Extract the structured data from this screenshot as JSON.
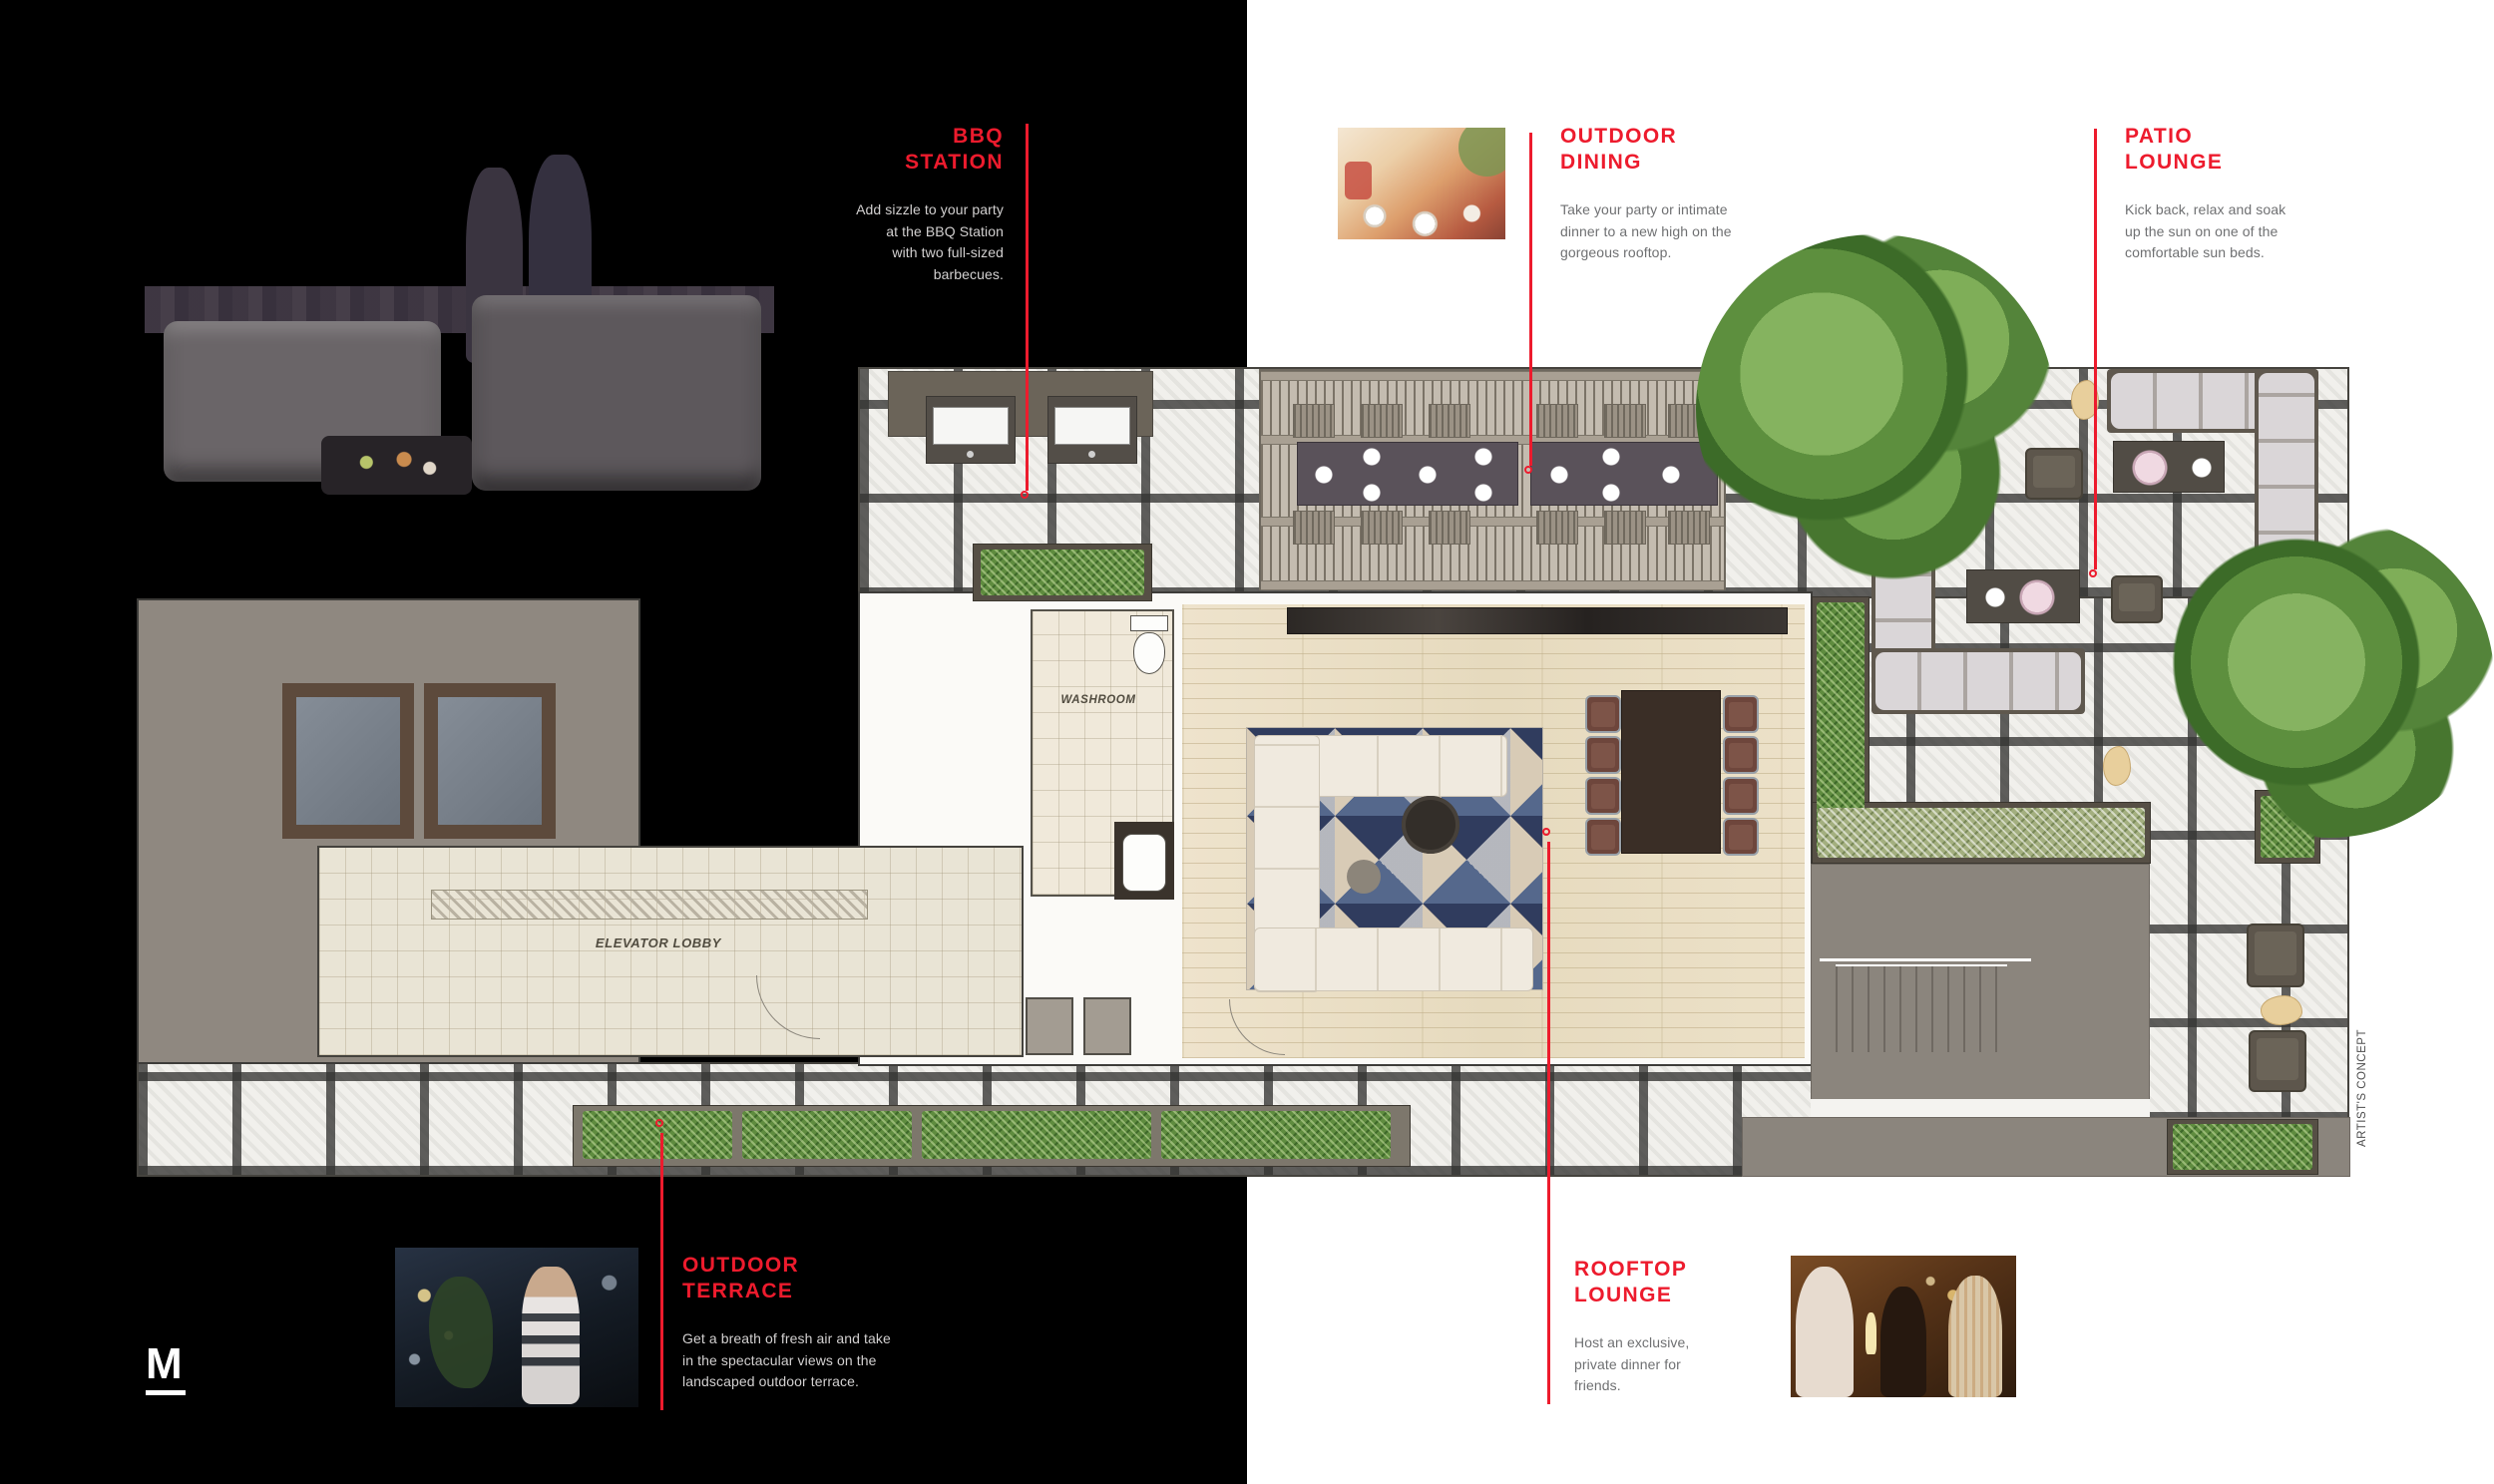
{
  "brand": {
    "logo": "M"
  },
  "artists_concept": "ARTIST'S CONCEPT",
  "colors": {
    "accent": "#ED1B2D",
    "background_left": "#000000",
    "background_right": "#FFFFFF"
  },
  "callouts": {
    "bbq_station": {
      "title": "BBQ\nSTATION",
      "body": "Add sizzle to your party\nat the BBQ Station\nwith two full-sized\nbarbecues."
    },
    "outdoor_dining": {
      "title": "OUTDOOR\nDINING",
      "body": "Take your party or intimate\ndinner to a new high on the\ngorgeous rooftop."
    },
    "patio_lounge": {
      "title": "PATIO\nLOUNGE",
      "body": "Kick back, relax and soak\nup the sun on one of the\ncomfortable sun beds."
    },
    "outdoor_terrace": {
      "title": "OUTDOOR\nTERRACE",
      "body": "Get a breath of fresh air and take\nin the spectacular views on the\nlandscaped outdoor terrace."
    },
    "rooftop_lounge": {
      "title": "ROOFTOP\nLOUNGE",
      "body": "Host an exclusive,\nprivate dinner for\nfriends."
    }
  },
  "plan_labels": {
    "washroom": "WASHROOM",
    "elevator_lobby": "ELEVATOR LOBBY"
  }
}
